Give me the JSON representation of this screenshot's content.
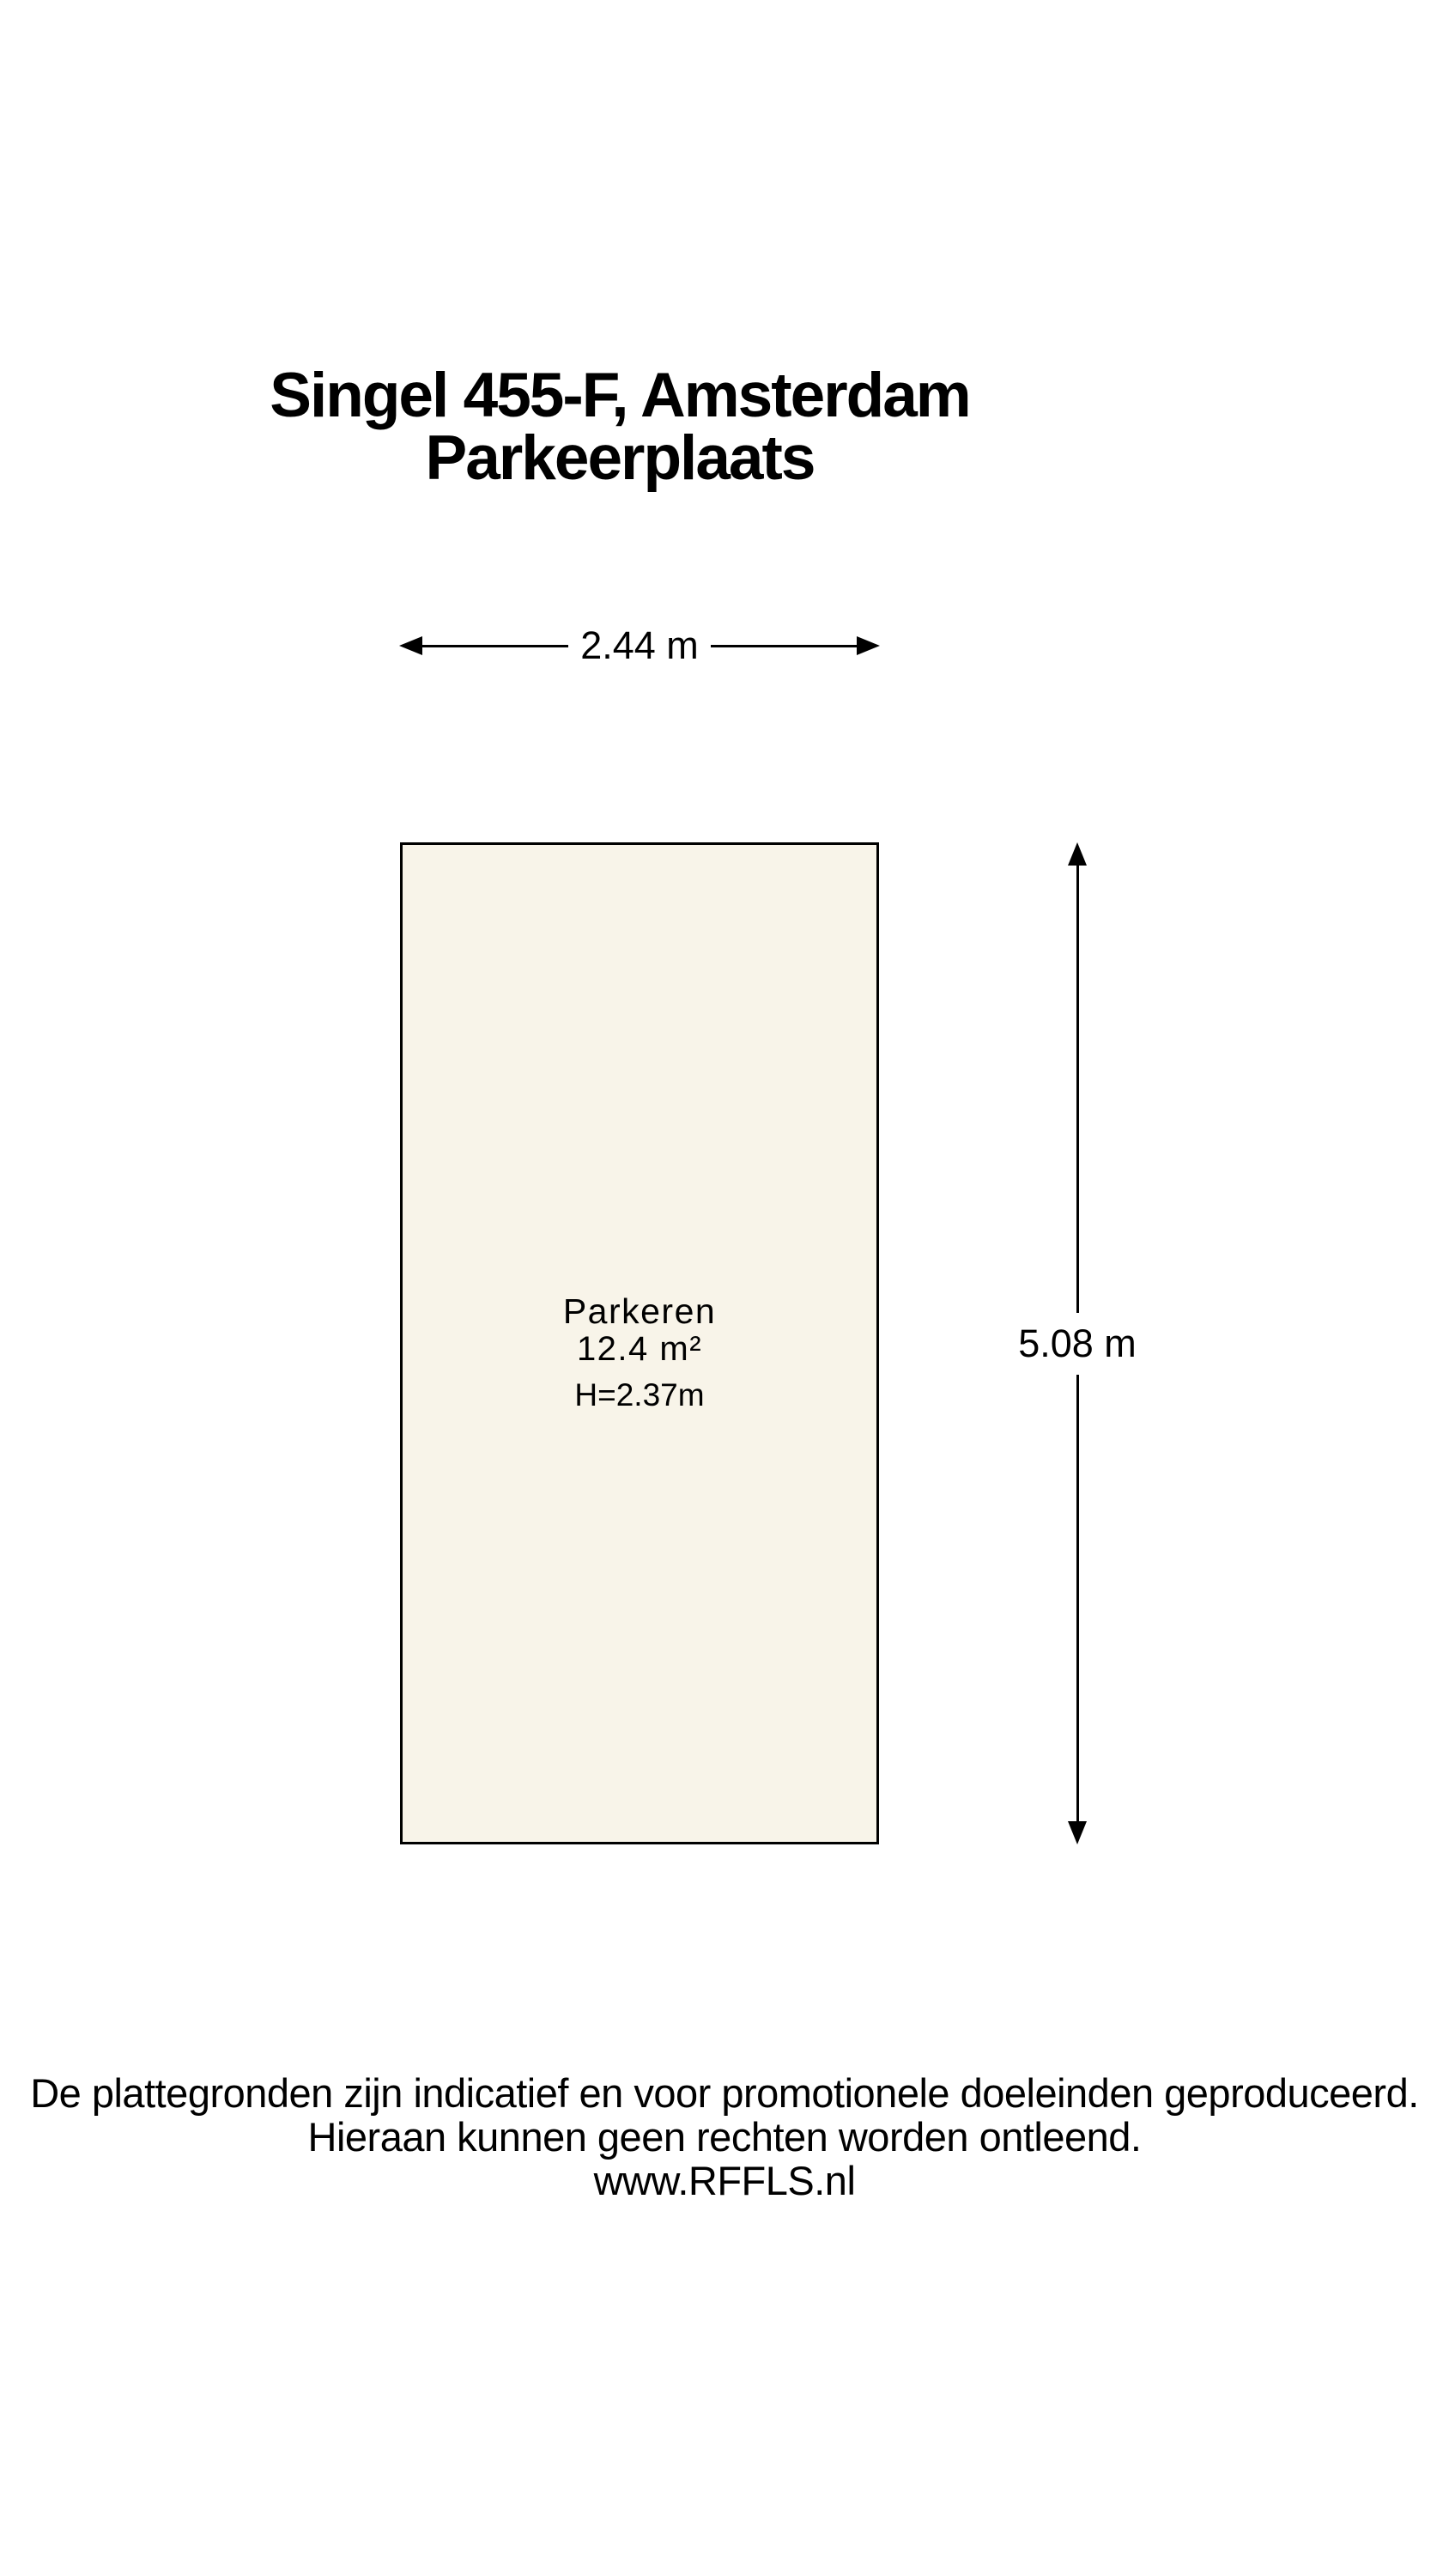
{
  "title": {
    "address": "Singel 455-F, Amsterdam",
    "subtitle": "Parkeerplaats"
  },
  "plan": {
    "width_label": "2.44 m",
    "depth_label": "5.08 m",
    "room": {
      "name": "Parkeren",
      "area": "12.4 m²",
      "ceiling_height": "H=2.37m"
    },
    "colors": {
      "room_fill": "#f8f4e9",
      "outline": "#000000"
    }
  },
  "footer": {
    "line1": "De plattegronden zijn indicatief en voor promotionele doeleinden geproduceerd.",
    "line2": "Hieraan kunnen geen rechten worden ontleend.",
    "website": "www.RFFLS.nl"
  }
}
